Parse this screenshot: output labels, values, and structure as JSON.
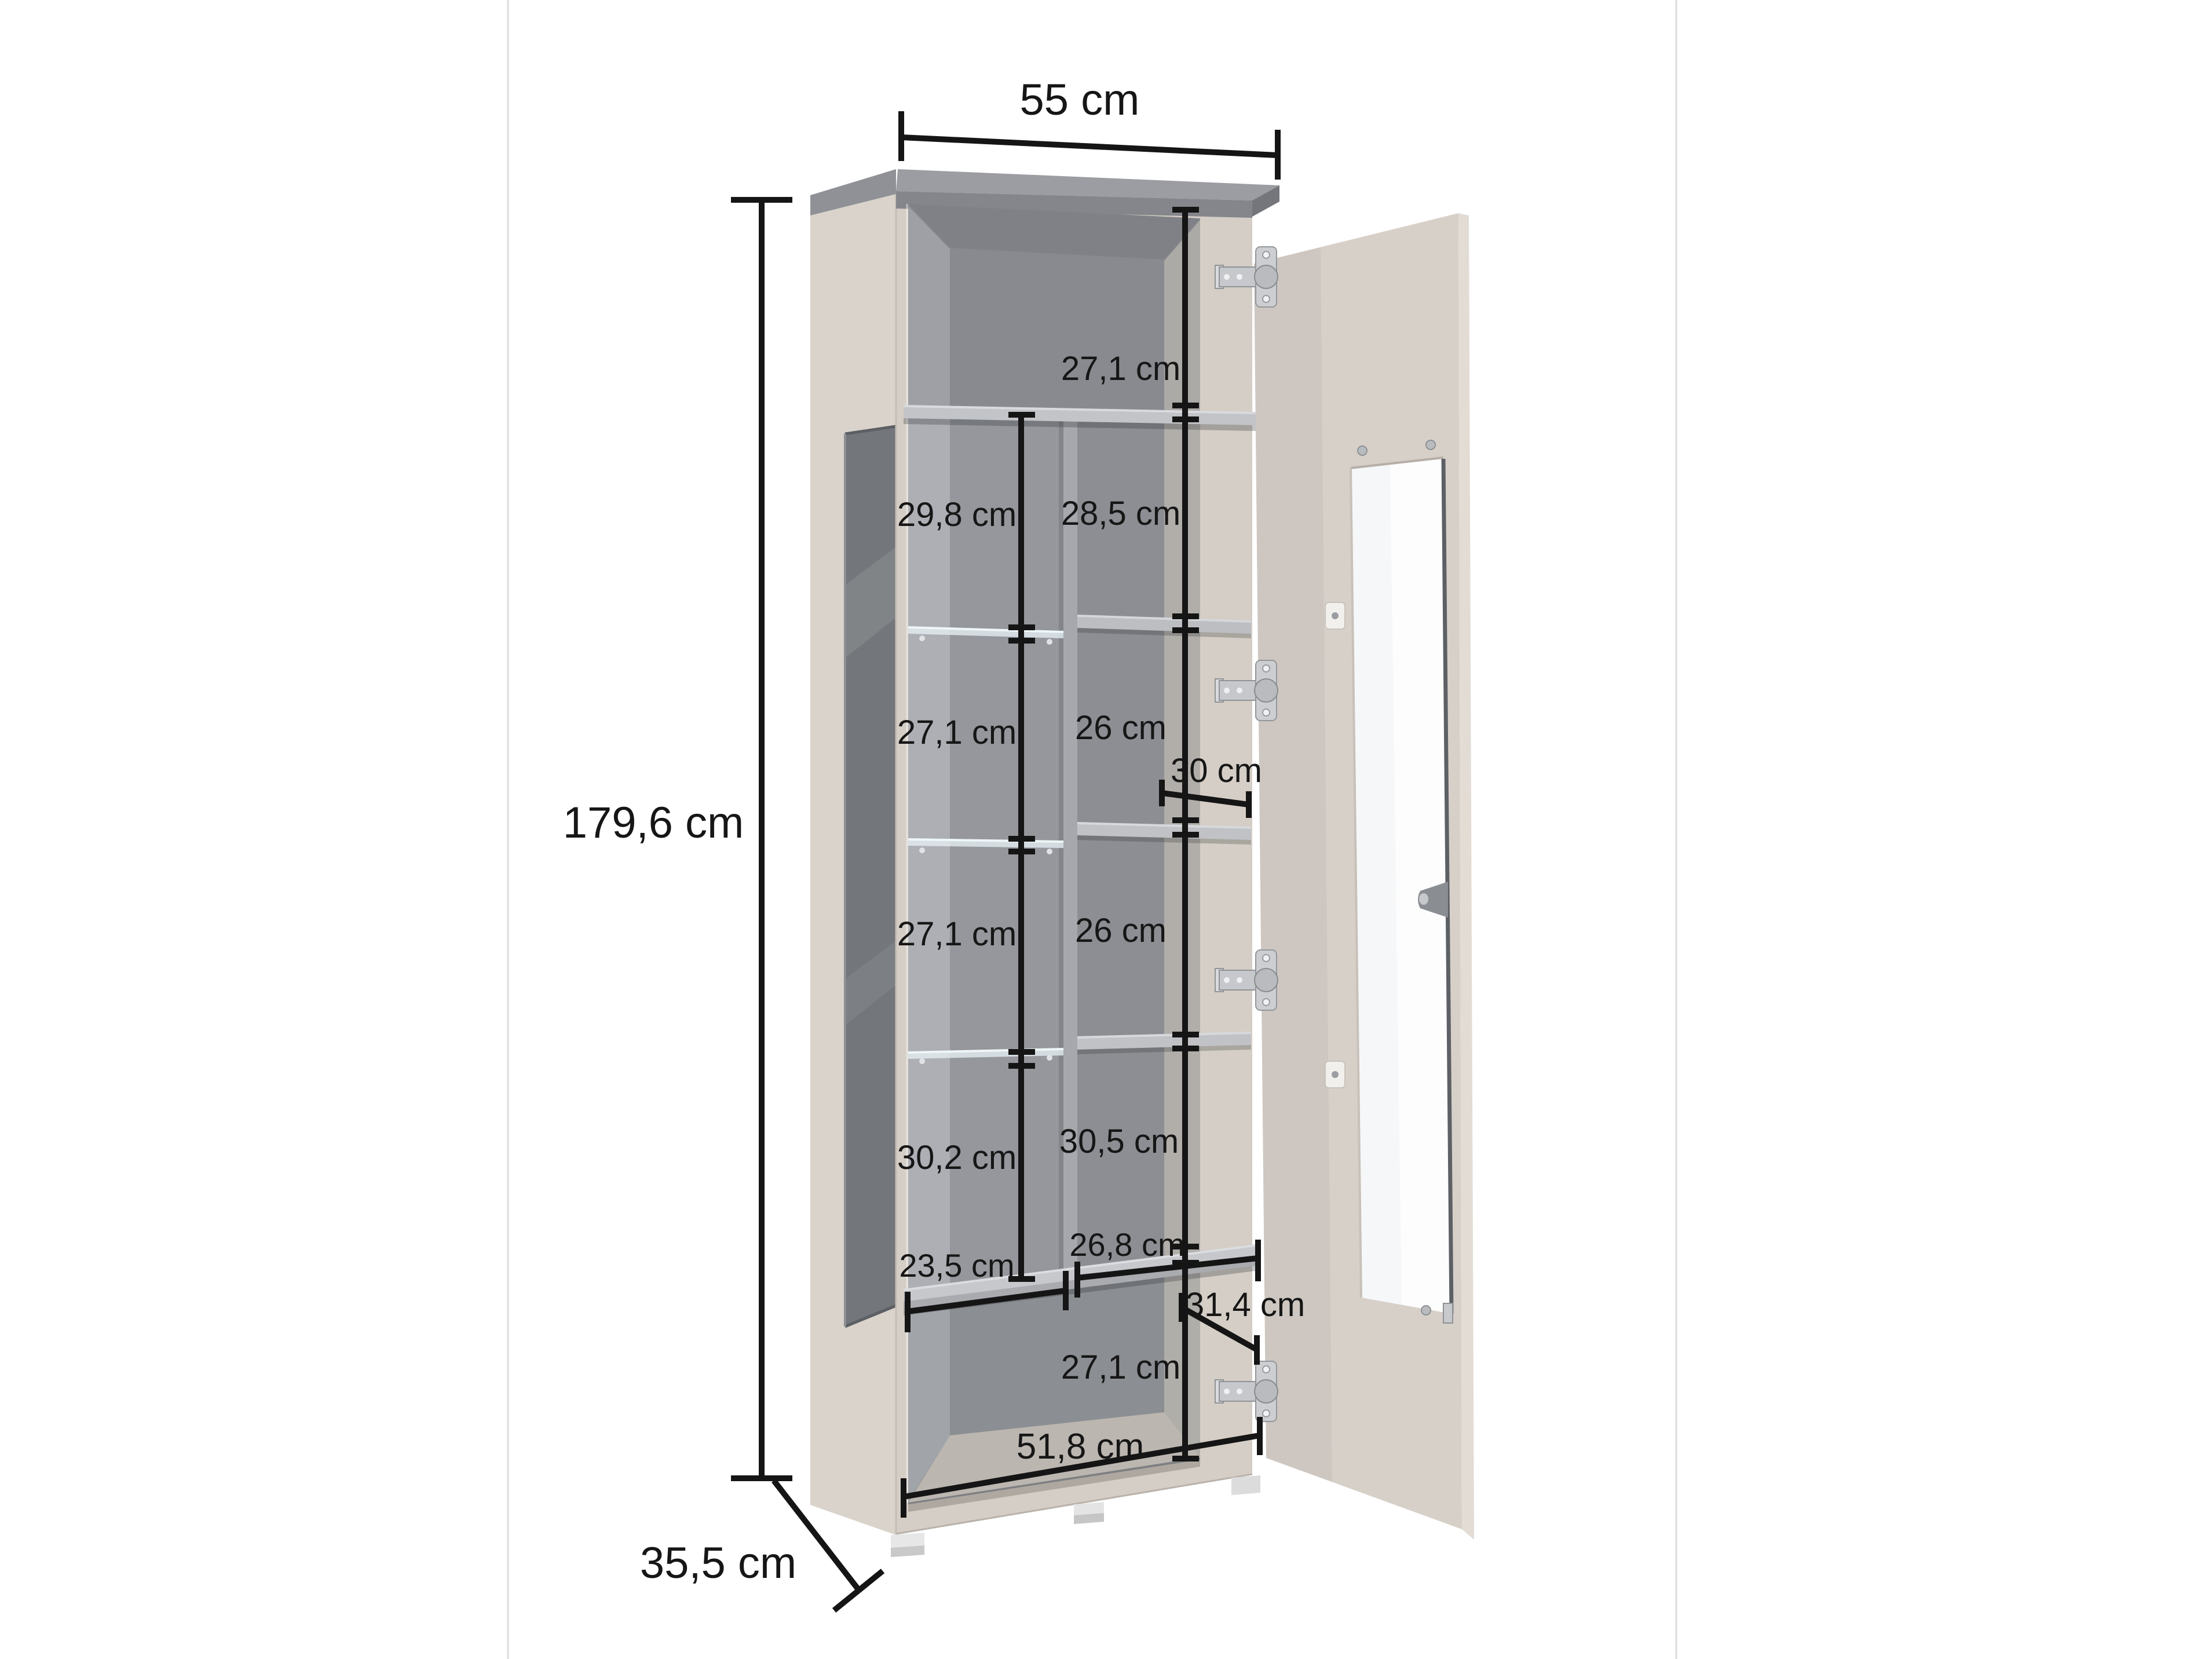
{
  "page": {
    "background": "#ffffff",
    "frame_line_color": "#dcdcdc",
    "description": "Furniture dimension diagram of a tall display cabinet with one open glass door, chrome hinges, glass side panel, glass and wooden shelves"
  },
  "dimensions": {
    "top_width": "55 cm",
    "total_height": "179,6 cm",
    "total_depth": "35,5 cm",
    "top_section_height": "27,1 cm",
    "left_column_heights": [
      "29,8 cm",
      "27,1 cm",
      "27,1 cm",
      "30,2 cm"
    ],
    "right_column_heights": [
      "28,5 cm",
      "26 cm",
      "26 cm",
      "30,5 cm"
    ],
    "bottom_section_height": "27,1 cm",
    "middle_shelf_depth": "30 cm",
    "bottom_shelf_depth": "31,4 cm",
    "left_column_width": "23,5 cm",
    "right_column_width": "26,8 cm",
    "interior_bottom_width": "51,8 cm"
  },
  "colors": {
    "cabinet_front": "#d5cec6",
    "cabinet_side": "#d9d3cb",
    "door": "#d7d0c9",
    "top_panel": "#9b9da2",
    "interior_back": "#95979c",
    "shelf": "#c2c4c8",
    "side_glass": "#73767a",
    "dimension_line": "#151515",
    "chrome_hinge": "#c6c8cb",
    "feet": "#e7e7e7"
  }
}
